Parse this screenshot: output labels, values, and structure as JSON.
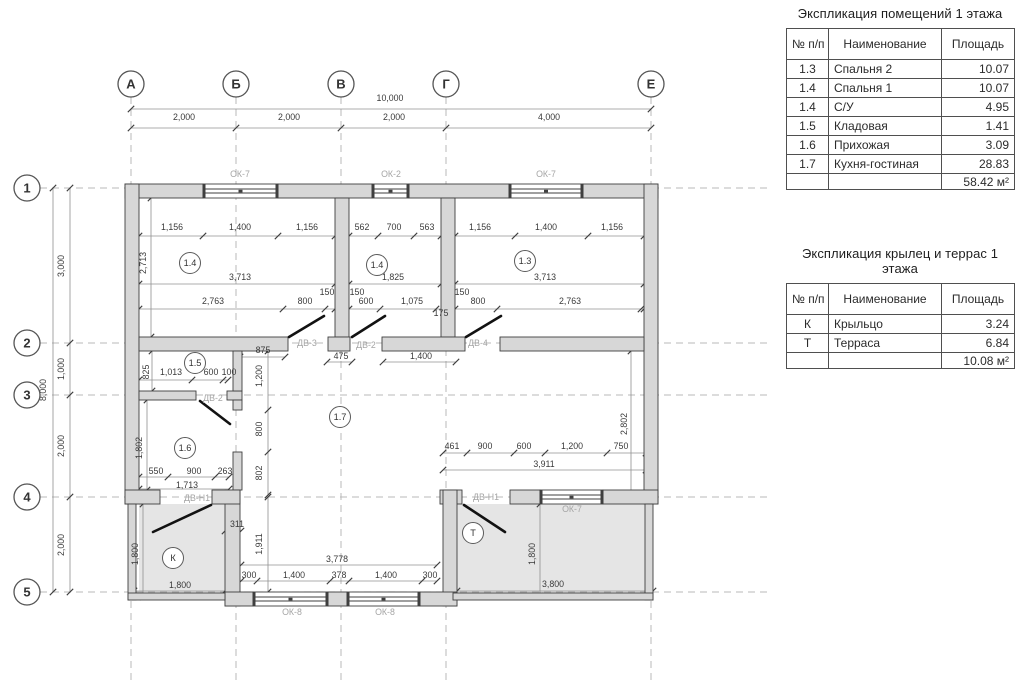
{
  "tables": [
    {
      "title": "Экспликация помещений 1 этажа",
      "headers": [
        "№ п/п",
        "Наименование",
        "Площадь"
      ],
      "rows": [
        [
          "1.3",
          "Спальня 2",
          "10.07"
        ],
        [
          "1.4",
          "Спальня 1",
          "10.07"
        ],
        [
          "1.4",
          "С/У",
          "4.95"
        ],
        [
          "1.5",
          "Кладовая",
          "1.41"
        ],
        [
          "1.6",
          "Прихожая",
          "3.09"
        ],
        [
          "1.7",
          "Кухня-гостиная",
          "28.83"
        ]
      ],
      "total": "58.42 м²"
    },
    {
      "title": "Экспликация крылец и террас 1 этажа",
      "headers": [
        "№ п/п",
        "Наименование",
        "Площадь"
      ],
      "rows": [
        [
          "К",
          "Крыльцо",
          "3.24"
        ],
        [
          "Т",
          "Терраса",
          "6.84"
        ]
      ],
      "total": "10.08 м²"
    }
  ],
  "plan": {
    "axis_cols": [
      "А",
      "Б",
      "В",
      "Г",
      "Е"
    ],
    "axis_rows": [
      "1",
      "2",
      "3",
      "4",
      "5"
    ],
    "room_badges": [
      {
        "t": "1.4",
        "x": 190,
        "y": 263
      },
      {
        "t": "1.4",
        "x": 377,
        "y": 265
      },
      {
        "t": "1.3",
        "x": 525,
        "y": 261
      },
      {
        "t": "1.5",
        "x": 195,
        "y": 363
      },
      {
        "t": "1.6",
        "x": 185,
        "y": 448
      },
      {
        "t": "1.7",
        "x": 340,
        "y": 417
      },
      {
        "t": "К",
        "x": 173,
        "y": 558
      },
      {
        "t": "Т",
        "x": 473,
        "y": 533
      }
    ],
    "opening_labels": [
      {
        "t": "ОК-7",
        "x": 240,
        "y": 177
      },
      {
        "t": "ОК-2",
        "x": 391,
        "y": 177
      },
      {
        "t": "ОК-7",
        "x": 546,
        "y": 177
      },
      {
        "t": "ДВ-3",
        "x": 307,
        "y": 346
      },
      {
        "t": "ДВ-2",
        "x": 366,
        "y": 348
      },
      {
        "t": "ДВ-4",
        "x": 478,
        "y": 346
      },
      {
        "t": "ДВ-2",
        "x": 213,
        "y": 401
      },
      {
        "t": "ДВ-Н1",
        "x": 197,
        "y": 501
      },
      {
        "t": "ДВ-Н1",
        "x": 486,
        "y": 500
      },
      {
        "t": "ОК-7",
        "x": 572,
        "y": 512
      },
      {
        "t": "ОК-8",
        "x": 292,
        "y": 615
      },
      {
        "t": "ОК-8",
        "x": 385,
        "y": 615
      }
    ],
    "dims": [
      {
        "t": "10,000",
        "x": 390,
        "y": 101
      },
      {
        "t": "2,000",
        "x": 184,
        "y": 120
      },
      {
        "t": "2,000",
        "x": 289,
        "y": 120
      },
      {
        "t": "2,000",
        "x": 394,
        "y": 120
      },
      {
        "t": "4,000",
        "x": 549,
        "y": 120
      },
      {
        "t": "8,000",
        "x": 46,
        "y": 390,
        "r": 1
      },
      {
        "t": "3,000",
        "x": 64,
        "y": 266,
        "r": 1
      },
      {
        "t": "1,000",
        "x": 64,
        "y": 369,
        "r": 1
      },
      {
        "t": "2,000",
        "x": 64,
        "y": 446,
        "r": 1
      },
      {
        "t": "2,000",
        "x": 64,
        "y": 545,
        "r": 1
      },
      {
        "t": "1,156",
        "x": 172,
        "y": 230
      },
      {
        "t": "1,400",
        "x": 240,
        "y": 230
      },
      {
        "t": "1,156",
        "x": 307,
        "y": 230
      },
      {
        "t": "2,713",
        "x": 146,
        "y": 263,
        "r": 1
      },
      {
        "t": "3,713",
        "x": 240,
        "y": 280
      },
      {
        "t": "2,763",
        "x": 213,
        "y": 304
      },
      {
        "t": "800",
        "x": 305,
        "y": 304
      },
      {
        "t": "150",
        "x": 327,
        "y": 295
      },
      {
        "t": "562",
        "x": 362,
        "y": 230
      },
      {
        "t": "700",
        "x": 394,
        "y": 230
      },
      {
        "t": "563",
        "x": 427,
        "y": 230
      },
      {
        "t": "1,825",
        "x": 393,
        "y": 280
      },
      {
        "t": "150",
        "x": 357,
        "y": 295
      },
      {
        "t": "600",
        "x": 366,
        "y": 304
      },
      {
        "t": "1,075",
        "x": 412,
        "y": 304
      },
      {
        "t": "175",
        "x": 441,
        "y": 316
      },
      {
        "t": "150",
        "x": 462,
        "y": 295
      },
      {
        "t": "800",
        "x": 478,
        "y": 304
      },
      {
        "t": "1,156",
        "x": 480,
        "y": 230
      },
      {
        "t": "1,400",
        "x": 546,
        "y": 230
      },
      {
        "t": "1,156",
        "x": 612,
        "y": 230
      },
      {
        "t": "3,713",
        "x": 545,
        "y": 280
      },
      {
        "t": "2,763",
        "x": 570,
        "y": 304
      },
      {
        "t": "875",
        "x": 263,
        "y": 353
      },
      {
        "t": "475",
        "x": 341,
        "y": 359
      },
      {
        "t": "1,400",
        "x": 421,
        "y": 359
      },
      {
        "t": "825",
        "x": 149,
        "y": 372,
        "r": 1
      },
      {
        "t": "1,013",
        "x": 171,
        "y": 375
      },
      {
        "t": "600",
        "x": 211,
        "y": 375
      },
      {
        "t": "100",
        "x": 229,
        "y": 375
      },
      {
        "t": "1,200",
        "x": 262,
        "y": 376,
        "r": 1
      },
      {
        "t": "800",
        "x": 262,
        "y": 429,
        "r": 1
      },
      {
        "t": "802",
        "x": 262,
        "y": 473,
        "r": 1
      },
      {
        "t": "1,802",
        "x": 142,
        "y": 448,
        "r": 1
      },
      {
        "t": "550",
        "x": 156,
        "y": 474
      },
      {
        "t": "900",
        "x": 194,
        "y": 474
      },
      {
        "t": "263",
        "x": 225,
        "y": 474
      },
      {
        "t": "1,713",
        "x": 187,
        "y": 488
      },
      {
        "t": "311",
        "x": 237,
        "y": 527
      },
      {
        "t": "1,911",
        "x": 262,
        "y": 544,
        "r": 1
      },
      {
        "t": "1,800",
        "x": 138,
        "y": 554,
        "r": 1
      },
      {
        "t": "1,800",
        "x": 180,
        "y": 588
      },
      {
        "t": "3,778",
        "x": 337,
        "y": 562
      },
      {
        "t": "300",
        "x": 249,
        "y": 578
      },
      {
        "t": "1,400",
        "x": 294,
        "y": 578
      },
      {
        "t": "378",
        "x": 339,
        "y": 578
      },
      {
        "t": "1,400",
        "x": 386,
        "y": 578
      },
      {
        "t": "300",
        "x": 430,
        "y": 578
      },
      {
        "t": "461",
        "x": 452,
        "y": 449
      },
      {
        "t": "900",
        "x": 485,
        "y": 449
      },
      {
        "t": "600",
        "x": 524,
        "y": 449
      },
      {
        "t": "1,200",
        "x": 572,
        "y": 449
      },
      {
        "t": "750",
        "x": 621,
        "y": 449
      },
      {
        "t": "3,911",
        "x": 544,
        "y": 467
      },
      {
        "t": "1,800",
        "x": 535,
        "y": 554,
        "r": 1
      },
      {
        "t": "3,800",
        "x": 553,
        "y": 587
      },
      {
        "t": "2,802",
        "x": 627,
        "y": 424,
        "r": 1
      }
    ],
    "colors": {
      "wall_fill": "#d7d7d7",
      "wall_stroke": "#3f3f3f",
      "porch_fill": "#e5e5e5",
      "dim_text": "#3a3a3a",
      "opening_text": "#a5a5a5",
      "axis_dash": "#b8b8b8"
    }
  }
}
